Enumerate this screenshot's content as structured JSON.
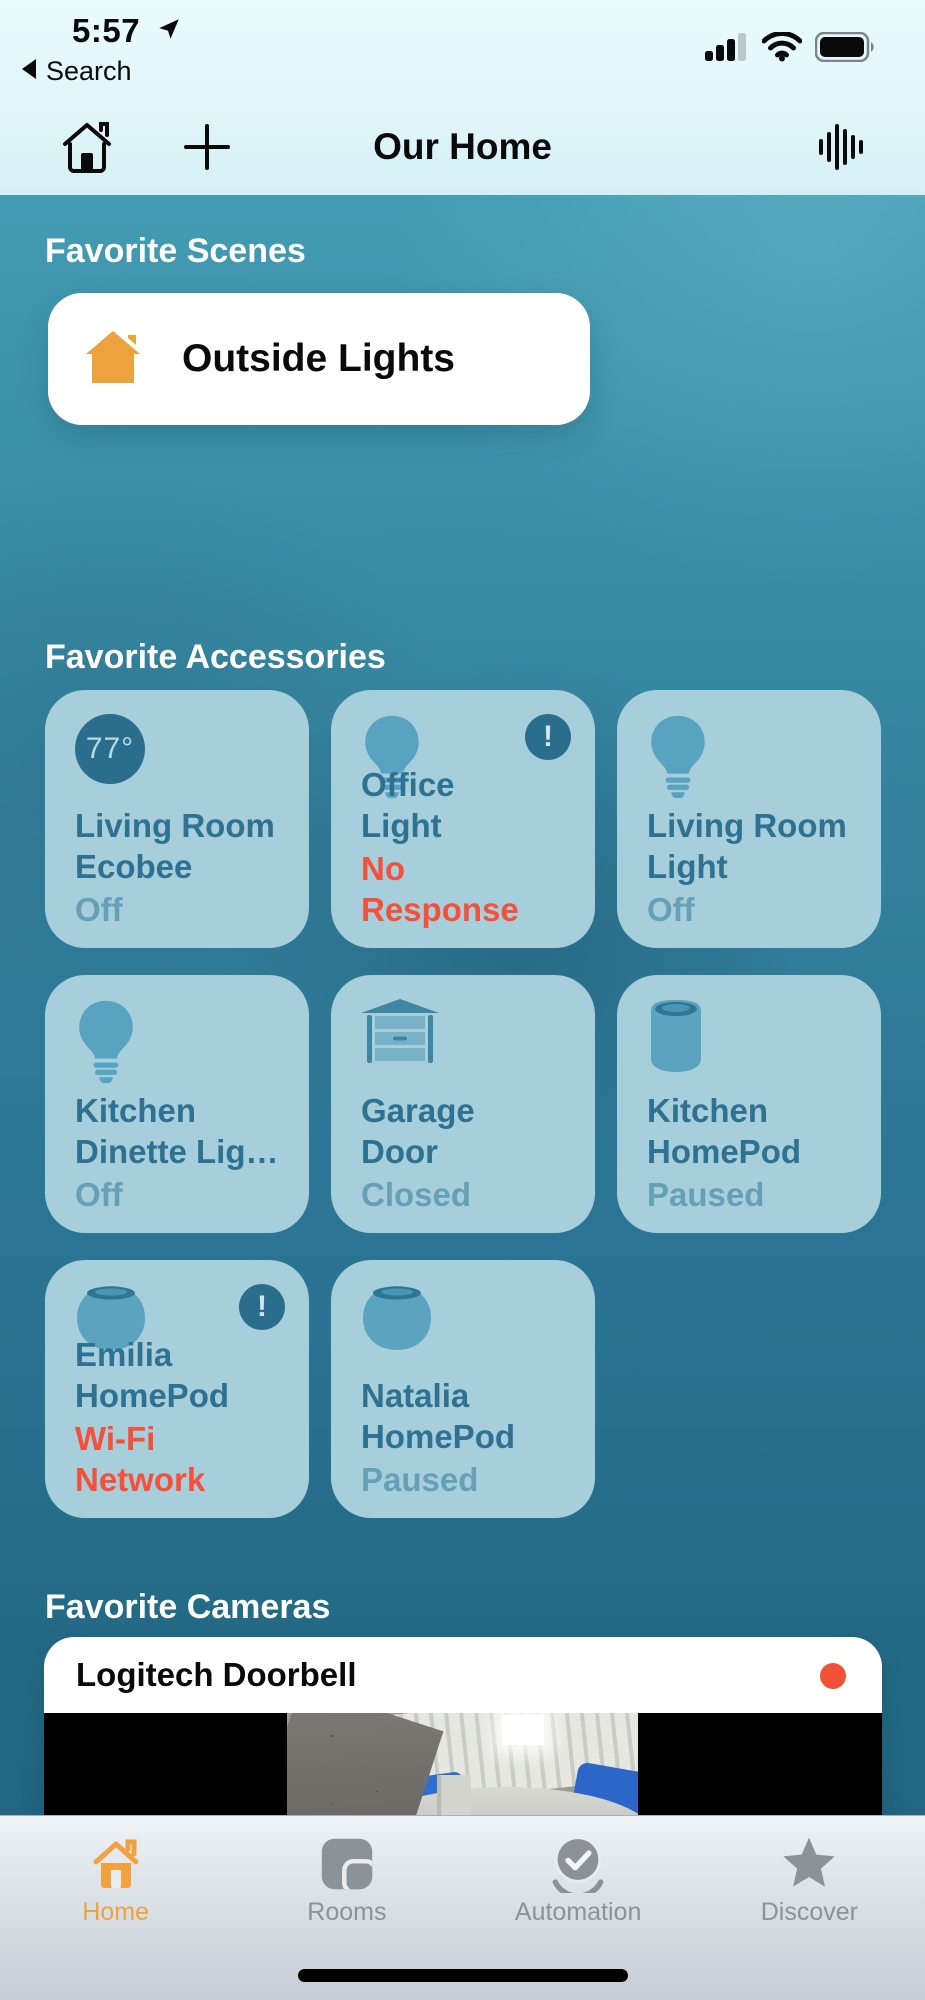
{
  "status_bar": {
    "time": "5:57",
    "back_label": "Search"
  },
  "header": {
    "title": "Our Home"
  },
  "sections": {
    "scenes": {
      "title": "Favorite Scenes",
      "scene": {
        "name": "Outside Lights"
      }
    },
    "accessories": {
      "title": "Favorite Accessories",
      "tiles": [
        {
          "name_line1": "Living Room",
          "name_line2": "Ecobee",
          "status": "Off",
          "icon": "thermostat",
          "badge_text": "77°",
          "alert": false
        },
        {
          "name_line1": "Office",
          "name_line2": "Light",
          "status": "No Response",
          "icon": "lightbulb",
          "alert": true
        },
        {
          "name_line1": "Living Room",
          "name_line2": "Light",
          "status": "Off",
          "icon": "lightbulb",
          "alert": false
        },
        {
          "name_line1": "Kitchen",
          "name_line2": "Dinette Lig…",
          "status": "Off",
          "icon": "lightbulb",
          "alert": false
        },
        {
          "name_line1": "Garage",
          "name_line2": "Door",
          "status": "Closed",
          "icon": "garage-door",
          "alert": false
        },
        {
          "name_line1": "Kitchen",
          "name_line2": "HomePod",
          "status": "Paused",
          "icon": "homepod",
          "alert": false
        },
        {
          "name_line1": "Emilia",
          "name_line2": "HomePod",
          "status": "Wi-Fi Network",
          "icon": "homepod-mini",
          "alert": true
        },
        {
          "name_line1": "Natalia",
          "name_line2": "HomePod",
          "status": "Paused",
          "icon": "homepod-mini",
          "alert": false
        }
      ]
    },
    "cameras": {
      "title": "Favorite Cameras",
      "camera": {
        "name": "Logitech Doorbell",
        "recording": true
      }
    }
  },
  "tab_bar": {
    "items": [
      {
        "label": "Home",
        "active": true
      },
      {
        "label": "Rooms",
        "active": false
      },
      {
        "label": "Automation",
        "active": false
      },
      {
        "label": "Discover",
        "active": false
      }
    ]
  },
  "colors": {
    "accent_orange": "#F0A23E",
    "alert_red": "#F4503A",
    "record_red": "#F25138",
    "tile_bg": "#A6CEDB",
    "tile_name": "#2F7190",
    "tile_status": "#65A0B7",
    "badge_bg": "#2A6D8C",
    "background_teal_top": "#4AA5BA",
    "background_teal_bottom": "#1E6080"
  }
}
